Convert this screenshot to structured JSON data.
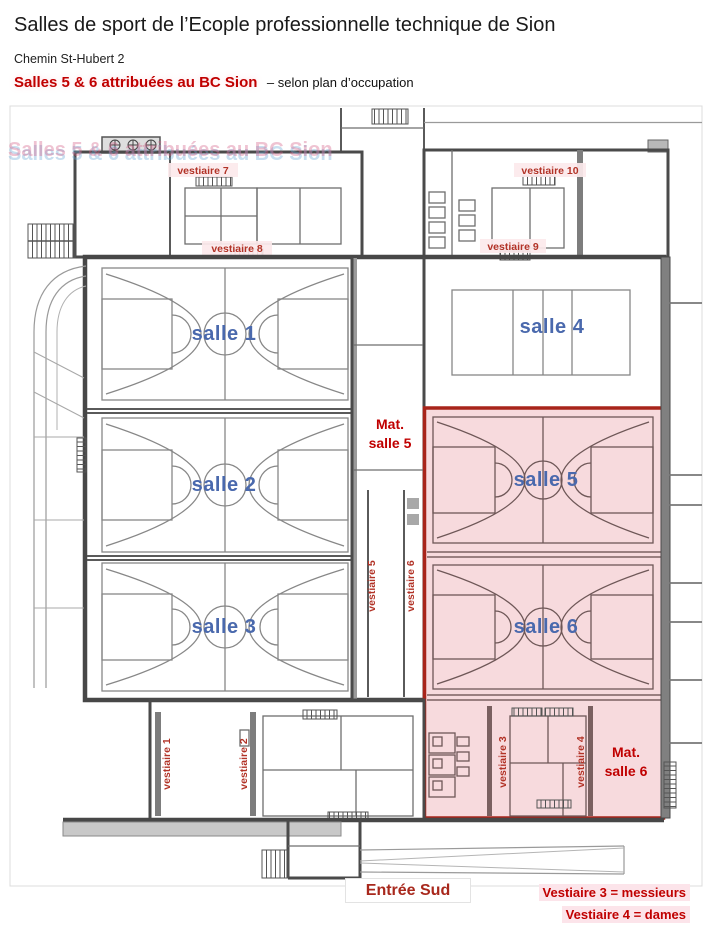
{
  "header": {
    "title": "Salles de sport de l’Ecople professionnelle technique de Sion",
    "address": "Chemin St-Hubert 2",
    "highlight": "Salles 5 & 6 attribuées au BC Sion",
    "highlight_suffix": "– selon plan d’occupation"
  },
  "plan": {
    "halls": [
      {
        "id": "salle-1",
        "label": "salle 1",
        "court": "basketball",
        "highlighted": false
      },
      {
        "id": "salle-2",
        "label": "salle 2",
        "court": "basketball",
        "highlighted": false
      },
      {
        "id": "salle-3",
        "label": "salle 3",
        "court": "basketball",
        "highlighted": false
      },
      {
        "id": "salle-4",
        "label": "salle 4",
        "court": "volleyball",
        "highlighted": false
      },
      {
        "id": "salle-5",
        "label": "salle 5",
        "court": "basketball",
        "highlighted": true
      },
      {
        "id": "salle-6",
        "label": "salle 6",
        "court": "basketball",
        "highlighted": true
      }
    ],
    "lockers": [
      "vestiaire 1",
      "vestiaire 2",
      "vestiaire 3",
      "vestiaire 4",
      "vestiaire 5",
      "vestiaire 6",
      "vestiaire 7",
      "vestiaire 8",
      "vestiaire 9",
      "vestiaire 10"
    ],
    "materials": [
      {
        "line1": "Mat.",
        "line2": "salle 5"
      },
      {
        "line1": "Mat.",
        "line2": "salle 6"
      }
    ],
    "entrance": "Entrée Sud"
  },
  "legend": {
    "notes": [
      "Vestiaire 3 = messieurs",
      "Vestiaire 4 = dames"
    ]
  },
  "colors": {
    "highlight_fill": "#f7dadd",
    "highlight_border": "#a8241a",
    "hall_label": "#4a69ad",
    "locker_label": "#b23327",
    "annotation": "#c00000",
    "wall": "#4a4a4a"
  }
}
